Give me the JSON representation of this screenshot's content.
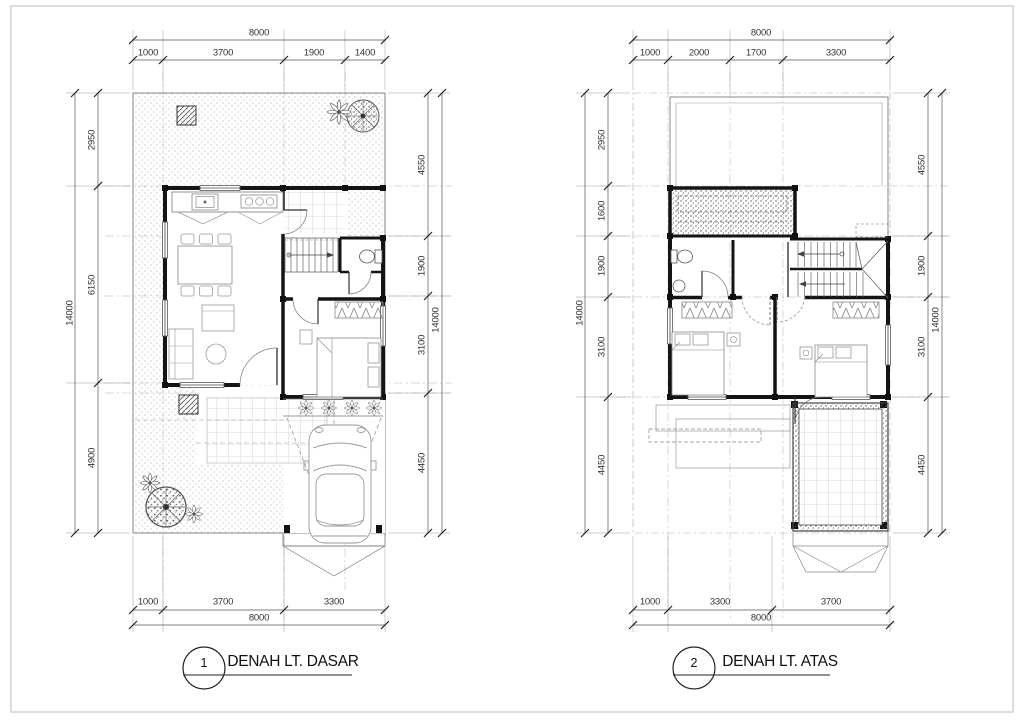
{
  "drawing": {
    "sheet_background": "#ffffff",
    "ink_color": "#1a1a1a",
    "dim_text_color": "#333333",
    "stipple_color": "#8a8a8a",
    "plans": [
      {
        "number": "1",
        "title": "DENAH LT. DASAR",
        "dimensions": {
          "top": {
            "total": "8000",
            "segments": [
              "1000",
              "3700",
              "1900",
              "1400"
            ]
          },
          "left": {
            "total": "14000",
            "segments": [
              "2950",
              "6150",
              "4900"
            ]
          },
          "right": {
            "total": "14000",
            "segments": [
              "4550",
              "1900",
              "3100",
              "4450"
            ]
          },
          "bottom": {
            "total": "8000",
            "segments": [
              "1000",
              "3700",
              "3300"
            ]
          }
        }
      },
      {
        "number": "2",
        "title": "DENAH LT. ATAS",
        "dimensions": {
          "top": {
            "total": "8000",
            "segments": [
              "1000",
              "2000",
              "1700",
              "3300"
            ]
          },
          "left": {
            "total": "14000",
            "segments": [
              "2950",
              "1600",
              "1900",
              "3100",
              "4450"
            ]
          },
          "right": {
            "total": "14000",
            "segments": [
              "4550",
              "1900",
              "3100",
              "4450"
            ]
          },
          "bottom": {
            "total": "8000",
            "segments": [
              "1000",
              "3300",
              "3700"
            ]
          }
        }
      }
    ]
  }
}
